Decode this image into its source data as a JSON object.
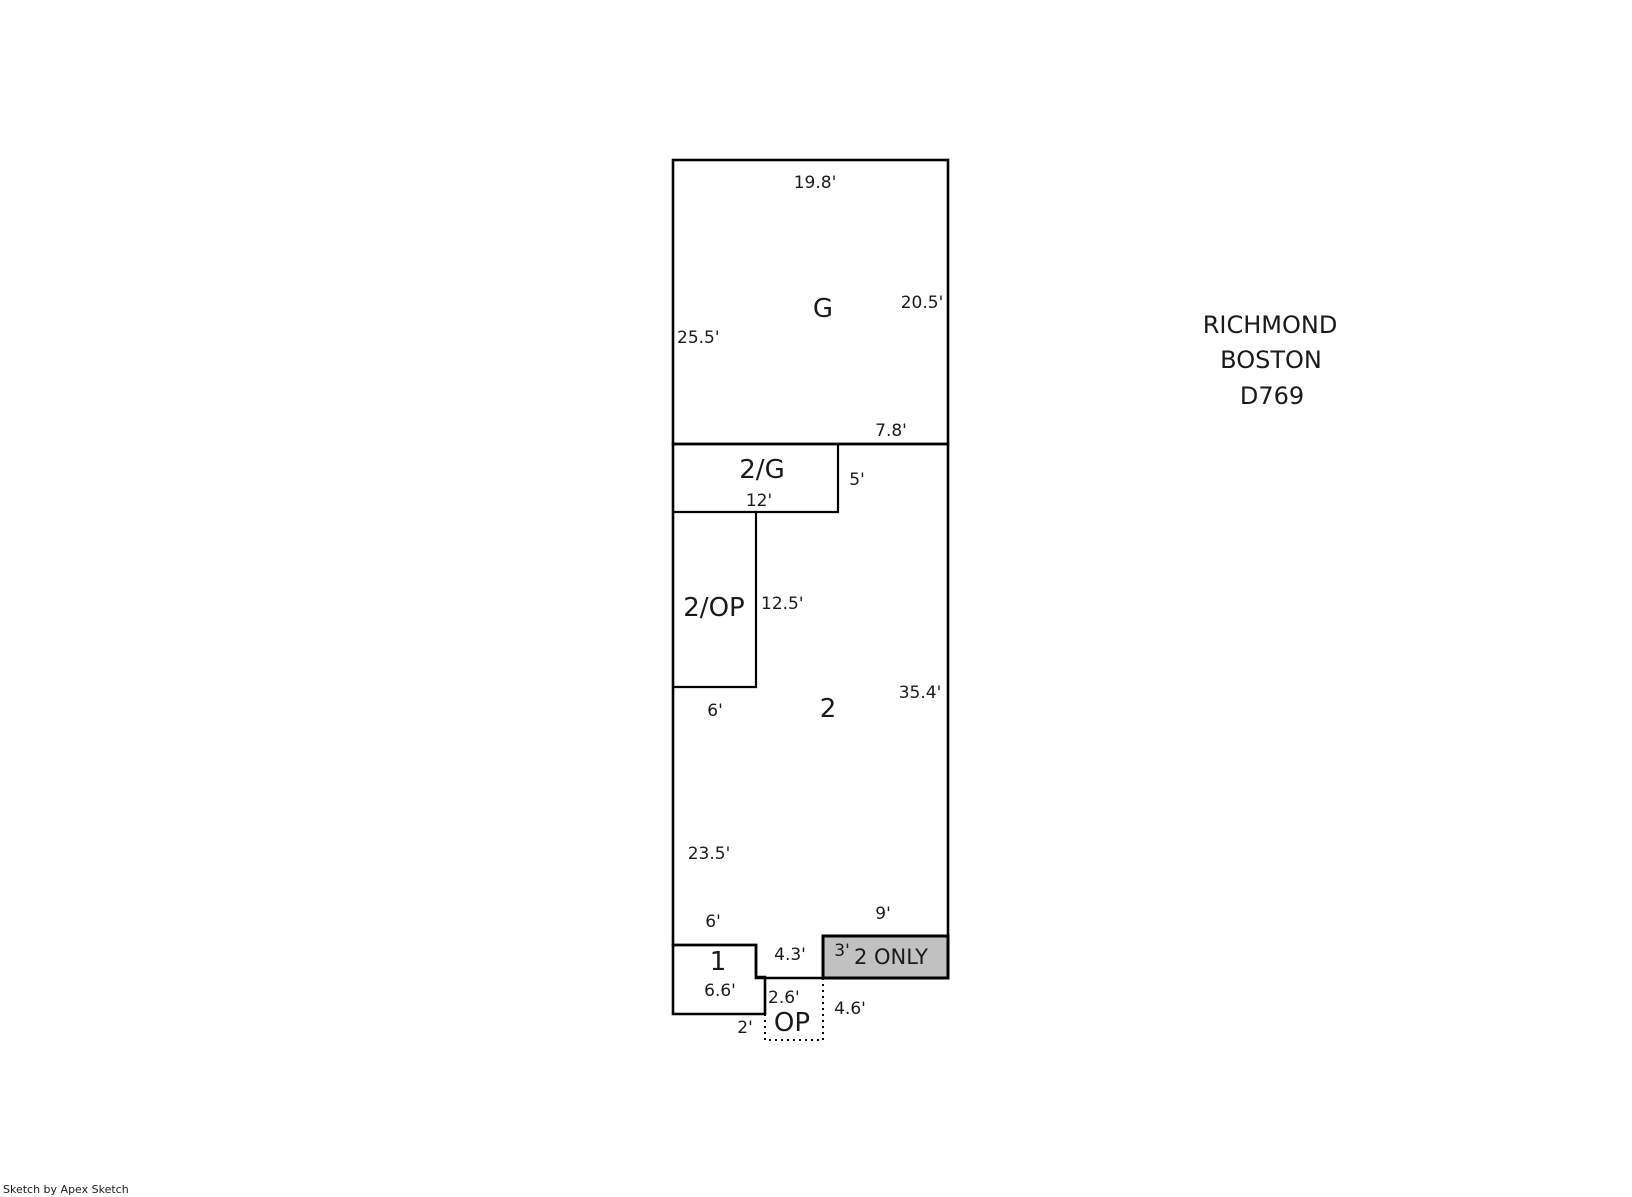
{
  "sketch": {
    "title_block": {
      "line1": "RICHMOND",
      "line2": "BOSTON",
      "line3": "D769"
    },
    "footer": {
      "credit": "Sketch by Apex Sketch"
    },
    "colors": {
      "area_fill": "#c1c1c1",
      "line": "#000000",
      "background": "#ffffff"
    },
    "areas": {
      "garage": {
        "label": "G"
      },
      "second_over_garage": {
        "label": "2/G"
      },
      "second_over_porch": {
        "label": "2/OP"
      },
      "second_floor": {
        "label": "2"
      },
      "first_floor": {
        "label": "1"
      },
      "open_porch": {
        "label": "OP"
      },
      "second_only": {
        "label": "2 ONLY"
      }
    },
    "dimensions": {
      "g_top": "19.8'",
      "g_right": "20.5'",
      "g_left": "25.5'",
      "g_bottom": "7.8'",
      "two_g_right": "5'",
      "two_g_bottom": "12'",
      "two_op_right": "12.5'",
      "two_op_bottom": "6'",
      "two_right": "35.4'",
      "two_left": "23.5'",
      "two_left_lower": "6'",
      "two_only_top": "9'",
      "mid_bottom": "4.3'",
      "two_only_left": "3'",
      "one_inner": "6.6'",
      "one_bottom": "2'",
      "op_left": "2.6'",
      "op_right": "4.6'"
    }
  }
}
